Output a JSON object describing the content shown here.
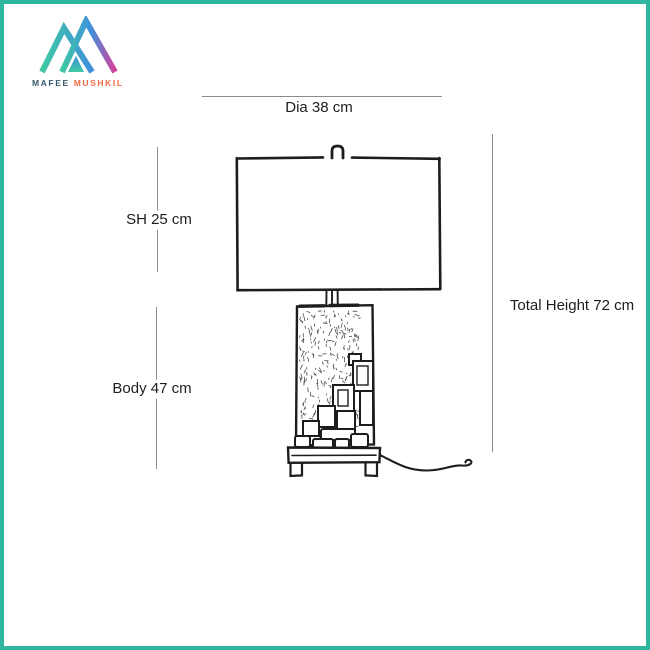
{
  "brand": {
    "name_primary": "MAFEE",
    "name_secondary": "MUSHKIL",
    "logo_icon": "m-mountain-gradient-icon"
  },
  "diagram": {
    "subject": "table-lamp-dimension-drawing",
    "labels": {
      "diameter": "Dia 38 cm",
      "shade_height": "SH 25 cm",
      "body_height": "Body 47 cm",
      "total_height": "Total Height 72 cm"
    }
  },
  "colors": {
    "border_teal": "#2eb6a1",
    "dim_line": "#8b8b8b",
    "ink": "#1d1d1d",
    "brand_primary_text": "#33596b",
    "brand_secondary_text": "#ef6a45",
    "logo_teal": "#3fc9a4",
    "logo_blue": "#3f8fdc",
    "logo_magenta": "#d8429b"
  }
}
